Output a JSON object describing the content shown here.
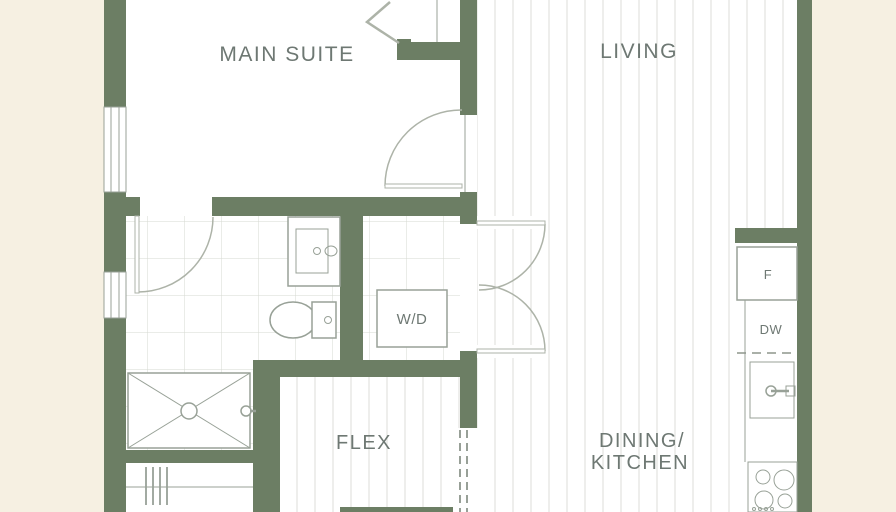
{
  "plan": {
    "rooms": {
      "main_suite": "MAIN SUITE",
      "living": "LIVING",
      "flex": "FLEX",
      "dining_kitchen_line1": "DINING/",
      "dining_kitchen_line2": "KITCHEN"
    },
    "fixtures": {
      "washer_dryer": "W/D",
      "fridge": "F",
      "dishwasher": "DW"
    }
  },
  "colors": {
    "background": "#f6f0e2",
    "wall": "#6c7e64",
    "floor": "#ffffff",
    "stripe": "#dcddd8",
    "tile": "#d6d9d2",
    "fixture": "#98a197",
    "door": "#adb3a8",
    "dash": "#8d968c",
    "text": "#6e7873"
  }
}
